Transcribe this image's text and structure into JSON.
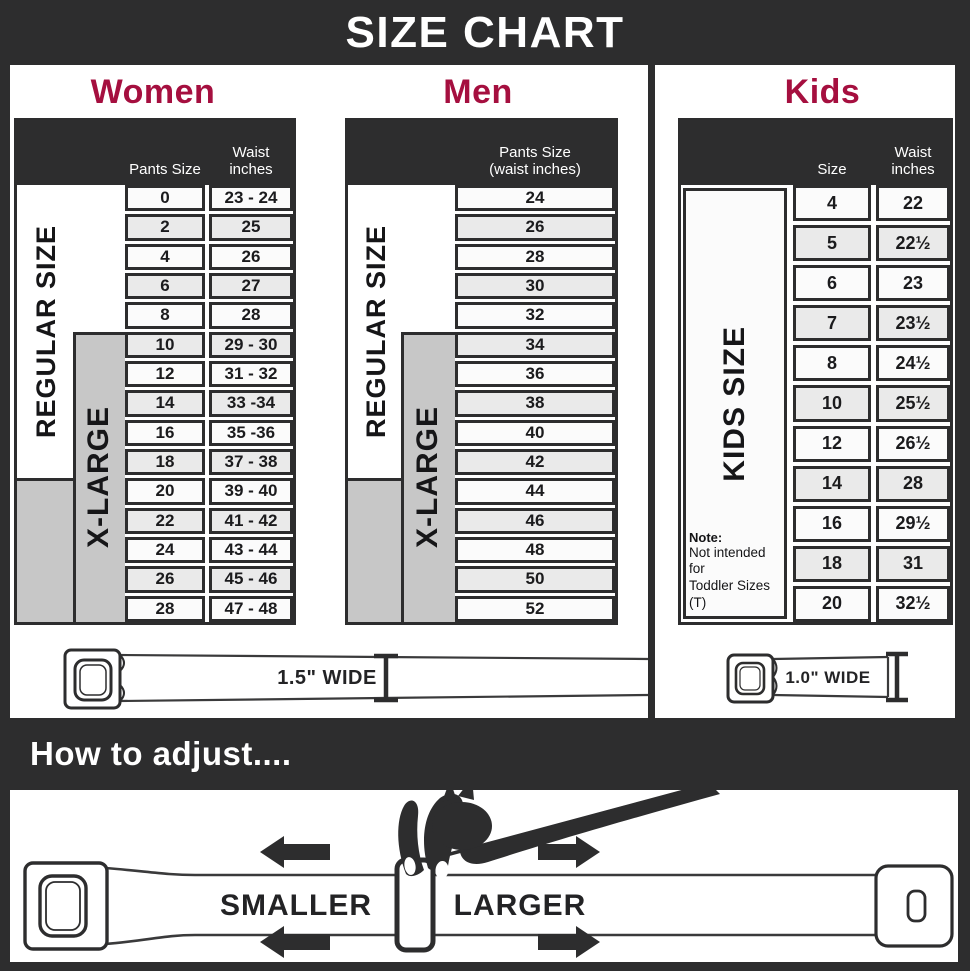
{
  "title": "SIZE CHART",
  "women": {
    "title": "Women",
    "pants_header": "Pants Size",
    "waist_header": [
      "Waist",
      "inches"
    ],
    "regular_label": "REGULAR SIZE",
    "xlarge_label": "X-LARGE",
    "rows": [
      {
        "size": "0",
        "waist": "23 - 24"
      },
      {
        "size": "2",
        "waist": "25"
      },
      {
        "size": "4",
        "waist": "26"
      },
      {
        "size": "6",
        "waist": "27"
      },
      {
        "size": "8",
        "waist": "28"
      },
      {
        "size": "10",
        "waist": "29 - 30"
      },
      {
        "size": "12",
        "waist": "31 - 32"
      },
      {
        "size": "14",
        "waist": "33 -34"
      },
      {
        "size": "16",
        "waist": "35 -36"
      },
      {
        "size": "18",
        "waist": "37 - 38"
      },
      {
        "size": "20",
        "waist": "39 - 40"
      },
      {
        "size": "22",
        "waist": "41 - 42"
      },
      {
        "size": "24",
        "waist": "43 - 44"
      },
      {
        "size": "26",
        "waist": "45 - 46"
      },
      {
        "size": "28",
        "waist": "47 - 48"
      }
    ]
  },
  "men": {
    "title": "Men",
    "header_lines": [
      "Pants Size",
      "(waist inches)"
    ],
    "regular_label": "REGULAR SIZE",
    "xlarge_label": "X-LARGE",
    "rows": [
      "24",
      "26",
      "28",
      "30",
      "32",
      "34",
      "36",
      "38",
      "40",
      "42",
      "44",
      "46",
      "48",
      "50",
      "52"
    ]
  },
  "kids": {
    "title": "Kids",
    "size_header": "Size",
    "waist_header": [
      "Waist",
      "inches"
    ],
    "side_label": "KIDS SIZE",
    "note_title": "Note:",
    "note_lines": [
      "Not intended for",
      "Toddler Sizes (T)"
    ],
    "rows": [
      {
        "size": "4",
        "waist": "22"
      },
      {
        "size": "5",
        "waist": "22½"
      },
      {
        "size": "6",
        "waist": "23"
      },
      {
        "size": "7",
        "waist": "23½"
      },
      {
        "size": "8",
        "waist": "24½"
      },
      {
        "size": "10",
        "waist": "25½"
      },
      {
        "size": "12",
        "waist": "26½"
      },
      {
        "size": "14",
        "waist": "28"
      },
      {
        "size": "16",
        "waist": "29½"
      },
      {
        "size": "18",
        "waist": "31"
      },
      {
        "size": "20",
        "waist": "32½"
      }
    ]
  },
  "adult_belt": {
    "label": "1.5\" WIDE"
  },
  "kids_belt": {
    "label": "1.0\" WIDE"
  },
  "adjust": {
    "banner": "How to adjust....",
    "smaller": "SMALLER",
    "larger": "LARGER"
  },
  "colors": {
    "accent": "#a50f3f",
    "dark": "#2d2d2e",
    "gray": "#c7c7c7"
  }
}
